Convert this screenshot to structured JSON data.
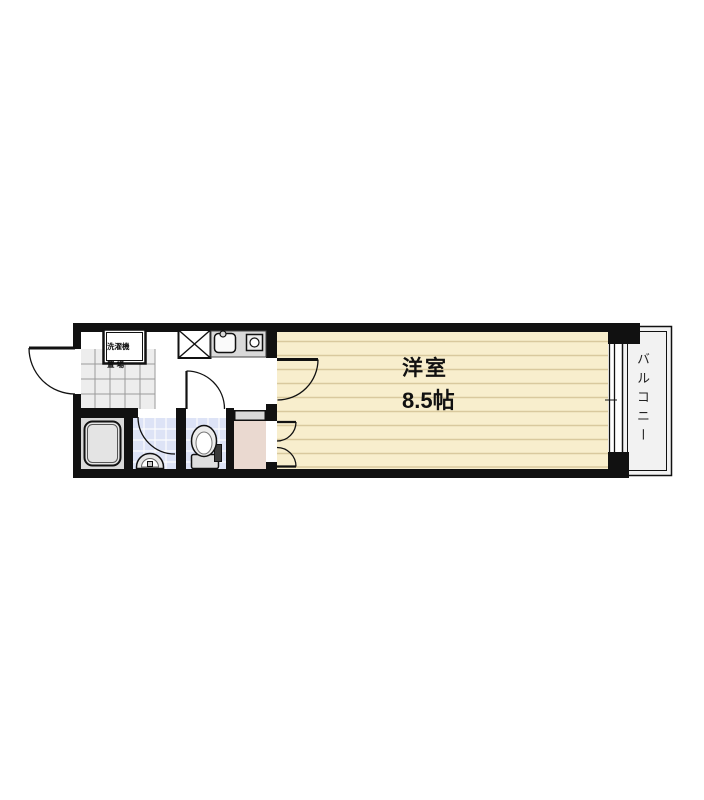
{
  "colors": {
    "wall": "#111111",
    "room-floor": "#f8eecd",
    "room-floor-line": "#d9c99e",
    "tile-blue": "#dde3f6",
    "closet": "#ead9d0",
    "counter": "#d9d9d9",
    "balcony-fill": "#f2f2f2",
    "genkan-fill": "#ededed"
  },
  "rooms": {
    "main_room": {
      "name": "洋室",
      "size": "8.5帖"
    },
    "balcony": {
      "label": "バルコニー"
    },
    "laundry": {
      "line1": "洗濯機",
      "line2": "置 場"
    }
  }
}
